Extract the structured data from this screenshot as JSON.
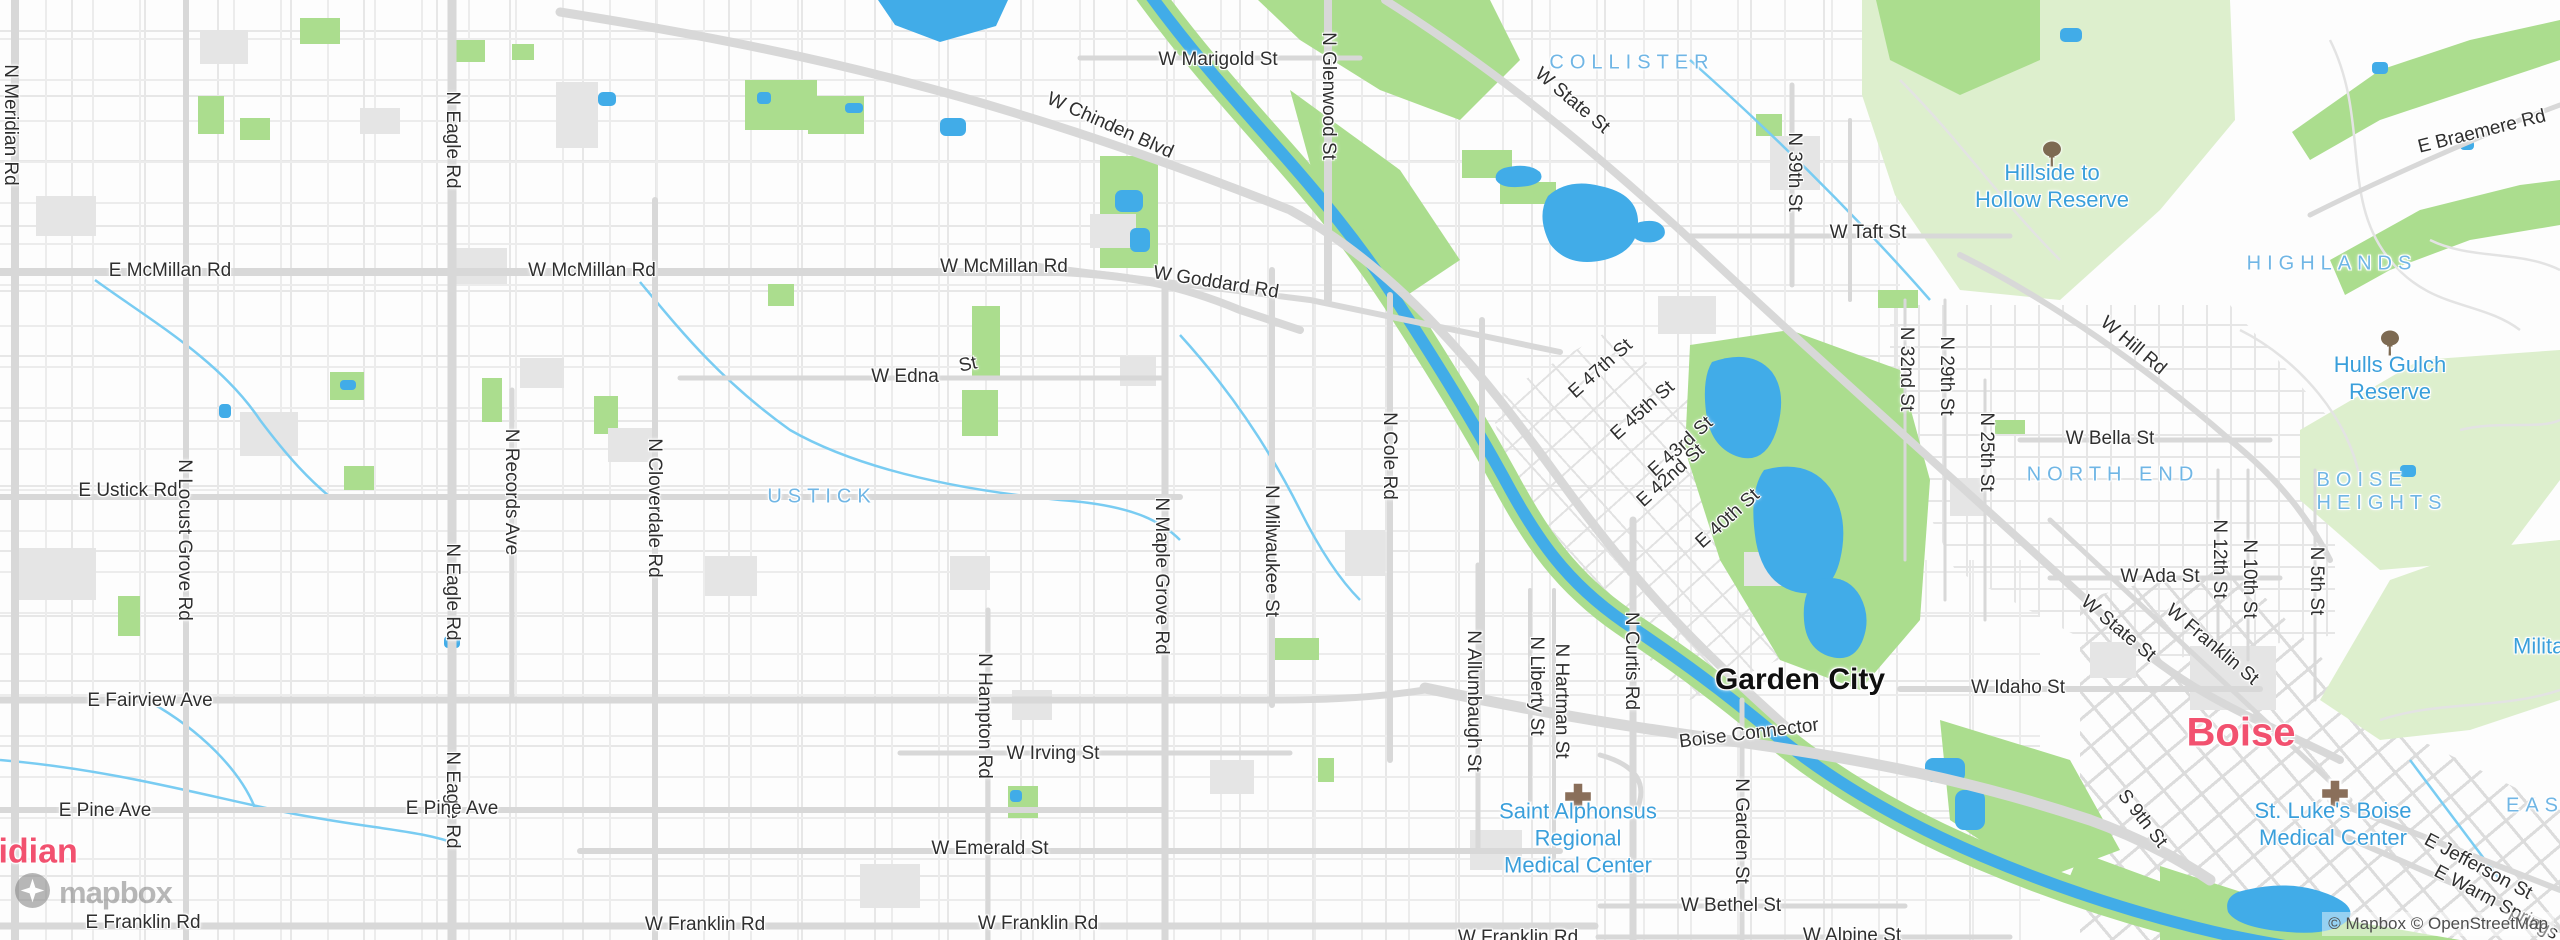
{
  "attribution": {
    "text": "© Mapbox © OpenStreetMap"
  },
  "logo": {
    "wordmark": "mapbox"
  },
  "colors": {
    "water": "#41ace8",
    "canal": "#79ccf2",
    "park_bright": "#abdd8e",
    "park_pale": "#ddefcd",
    "road": "#d8d8d8",
    "block": "#e5e5e5",
    "street_text": "#2f2f2f",
    "neighborhood_text": "#70b6e5",
    "poi_text": "#3a9fdb",
    "city_pink": "#f2516f"
  },
  "labels": {
    "cities": [
      {
        "text": "Garden City",
        "x": 1800,
        "y": 680,
        "size": 30,
        "color": "#0f0f0f"
      },
      {
        "text": "Boise",
        "x": 2241,
        "y": 733,
        "size": 40,
        "color": "#f2516f"
      },
      {
        "text": "Meridian",
        "x": -62,
        "y": 852,
        "size": 34,
        "color": "#f2516f",
        "anchor": "left"
      }
    ],
    "neighborhoods": [
      {
        "lines": [
          "USTICK"
        ],
        "x": 822,
        "y": 497
      },
      {
        "lines": [
          "COLLISTER"
        ],
        "x": 1632,
        "y": 63
      },
      {
        "lines": [
          "HIGHLANDS"
        ],
        "x": 2332,
        "y": 264
      },
      {
        "lines": [
          "NORTH END"
        ],
        "x": 2113,
        "y": 475
      },
      {
        "lines": [
          "BOISE",
          "HEIGHTS"
        ],
        "x": 2382,
        "y": 492
      },
      {
        "lines": [
          "EAST END"
        ],
        "x": 2506,
        "y": 806,
        "anchor": "left"
      }
    ],
    "pois": [
      {
        "lines": [
          "Hillside to",
          "Hollow Reserve"
        ],
        "x": 2052,
        "y": 186,
        "icon": "tree-icon",
        "icon_x": 2052,
        "icon_y": 157
      },
      {
        "lines": [
          "Hulls Gulch",
          "Reserve"
        ],
        "x": 2390,
        "y": 378,
        "icon": "tree-icon",
        "icon_x": 2390,
        "icon_y": 346
      },
      {
        "lines": [
          "Saint Alphonsus",
          "Regional",
          "Medical Center"
        ],
        "x": 1578,
        "y": 838,
        "icon": "hospital-icon",
        "icon_x": 1578,
        "icon_y": 799
      },
      {
        "lines": [
          "St. Luke's Boise",
          "Medical Center"
        ],
        "x": 2333,
        "y": 824,
        "icon": "hospital-icon",
        "icon_x": 2335,
        "icon_y": 796
      },
      {
        "lines": [
          "Military Reserve"
        ],
        "x": 2513,
        "y": 646,
        "anchor": "left"
      }
    ],
    "streets": [
      {
        "text": "N Meridian Rd",
        "x": 10,
        "y": 125,
        "rot": 90
      },
      {
        "text": "E McMillan Rd",
        "x": 170,
        "y": 271,
        "rot": 0
      },
      {
        "text": "W McMillan Rd",
        "x": 592,
        "y": 271,
        "rot": 0
      },
      {
        "text": "W McMillan Rd",
        "x": 1004,
        "y": 267,
        "rot": 0
      },
      {
        "text": "W Chinden Blvd",
        "x": 1110,
        "y": 126,
        "rot": 24
      },
      {
        "text": "W Marigold St",
        "x": 1218,
        "y": 60,
        "rot": 0
      },
      {
        "text": "N Glenwood St",
        "x": 1328,
        "y": 96,
        "rot": 90
      },
      {
        "text": "W State St",
        "x": 1572,
        "y": 101,
        "rot": 40
      },
      {
        "text": "W Goddard Rd",
        "x": 1216,
        "y": 283,
        "rot": 9
      },
      {
        "text": "W Edna",
        "x": 905,
        "y": 377,
        "rot": 0
      },
      {
        "text": "St",
        "x": 968,
        "y": 365,
        "rot": -12
      },
      {
        "text": "E Ustick Rd",
        "x": 128,
        "y": 491,
        "rot": 0
      },
      {
        "text": "N Locust Grove Rd",
        "x": 184,
        "y": 540,
        "rot": 90
      },
      {
        "text": "N Eagle Rd",
        "x": 452,
        "y": 140,
        "rot": 90
      },
      {
        "text": "N Eagle Rd",
        "x": 452,
        "y": 592,
        "rot": 90
      },
      {
        "text": "N Eagle Rd",
        "x": 452,
        "y": 800,
        "rot": 90
      },
      {
        "text": "N Records Ave",
        "x": 511,
        "y": 492,
        "rot": 90
      },
      {
        "text": "N Cloverdale Rd",
        "x": 654,
        "y": 508,
        "rot": 90
      },
      {
        "text": "W Taft St",
        "x": 1868,
        "y": 233,
        "rot": 0
      },
      {
        "text": "N 39th St",
        "x": 1794,
        "y": 172,
        "rot": 90
      },
      {
        "text": "W Hill Rd",
        "x": 2133,
        "y": 346,
        "rot": 40
      },
      {
        "text": "E Braemere Rd",
        "x": 2482,
        "y": 132,
        "rot": -14
      },
      {
        "text": "N 32nd St",
        "x": 1906,
        "y": 369,
        "rot": 90
      },
      {
        "text": "N 29th St",
        "x": 1946,
        "y": 376,
        "rot": 90
      },
      {
        "text": "N 25th St",
        "x": 1986,
        "y": 452,
        "rot": 90
      },
      {
        "text": "W Bella St",
        "x": 2110,
        "y": 439,
        "rot": 0
      },
      {
        "text": "W Ada St",
        "x": 2160,
        "y": 577,
        "rot": 0
      },
      {
        "text": "N 12th St",
        "x": 2219,
        "y": 559,
        "rot": 90
      },
      {
        "text": "N 10th St",
        "x": 2249,
        "y": 579,
        "rot": 90
      },
      {
        "text": "N 5th St",
        "x": 2316,
        "y": 581,
        "rot": 90
      },
      {
        "text": "E 47th St",
        "x": 1601,
        "y": 369,
        "rot": -42
      },
      {
        "text": "E 45th St",
        "x": 1643,
        "y": 411,
        "rot": -42
      },
      {
        "text": "E 43rd St",
        "x": 1681,
        "y": 447,
        "rot": -42
      },
      {
        "text": "E 42nd St",
        "x": 1671,
        "y": 476,
        "rot": -42
      },
      {
        "text": "E 40th St",
        "x": 1728,
        "y": 519,
        "rot": -42
      },
      {
        "text": "N Cole Rd",
        "x": 1389,
        "y": 456,
        "rot": 90
      },
      {
        "text": "N Maple Grove Rd",
        "x": 1161,
        "y": 576,
        "rot": 90
      },
      {
        "text": "N Milwaukee St",
        "x": 1271,
        "y": 551,
        "rot": 90
      },
      {
        "text": "W Irving St",
        "x": 1053,
        "y": 754,
        "rot": 0
      },
      {
        "text": "N Hampton Rd",
        "x": 984,
        "y": 716,
        "rot": 90
      },
      {
        "text": "W Emerald St",
        "x": 990,
        "y": 849,
        "rot": 0
      },
      {
        "text": "E Fairview Ave",
        "x": 150,
        "y": 701,
        "rot": 0
      },
      {
        "text": "E Pine Ave",
        "x": 105,
        "y": 811,
        "rot": 0
      },
      {
        "text": "E Pine Ave",
        "x": 452,
        "y": 809,
        "rot": 0
      },
      {
        "text": "E Franklin Rd",
        "x": 143,
        "y": 923,
        "rot": 0
      },
      {
        "text": "W Franklin Rd",
        "x": 705,
        "y": 925,
        "rot": 0
      },
      {
        "text": "W Franklin Rd",
        "x": 1038,
        "y": 924,
        "rot": 0
      },
      {
        "text": "W Franklin Rd",
        "x": 1518,
        "y": 938,
        "rot": 0
      },
      {
        "text": "W Bethel St",
        "x": 1731,
        "y": 906,
        "rot": 0
      },
      {
        "text": "W Alpine St",
        "x": 1852,
        "y": 936,
        "rot": 0
      },
      {
        "text": "N Garden St",
        "x": 1741,
        "y": 831,
        "rot": 90
      },
      {
        "text": "N Curtis Rd",
        "x": 1631,
        "y": 661,
        "rot": 90
      },
      {
        "text": "N Liberty St",
        "x": 1536,
        "y": 686,
        "rot": 90
      },
      {
        "text": "N Hartman St",
        "x": 1561,
        "y": 701,
        "rot": 90
      },
      {
        "text": "N Allumbaugh St",
        "x": 1473,
        "y": 701,
        "rot": 90
      },
      {
        "text": "Boise Connector",
        "x": 1749,
        "y": 734,
        "rot": -7
      },
      {
        "text": "W Idaho St",
        "x": 2018,
        "y": 688,
        "rot": 0
      },
      {
        "text": "W State St",
        "x": 2118,
        "y": 629,
        "rot": 40
      },
      {
        "text": "W Franklin St",
        "x": 2212,
        "y": 645,
        "rot": 40
      },
      {
        "text": "E Jefferson St",
        "x": 2478,
        "y": 867,
        "rot": 28
      },
      {
        "text": "E Warm Springs",
        "x": 2496,
        "y": 903,
        "rot": 28
      },
      {
        "text": "S 9th St",
        "x": 2142,
        "y": 819,
        "rot": 52
      }
    ]
  }
}
